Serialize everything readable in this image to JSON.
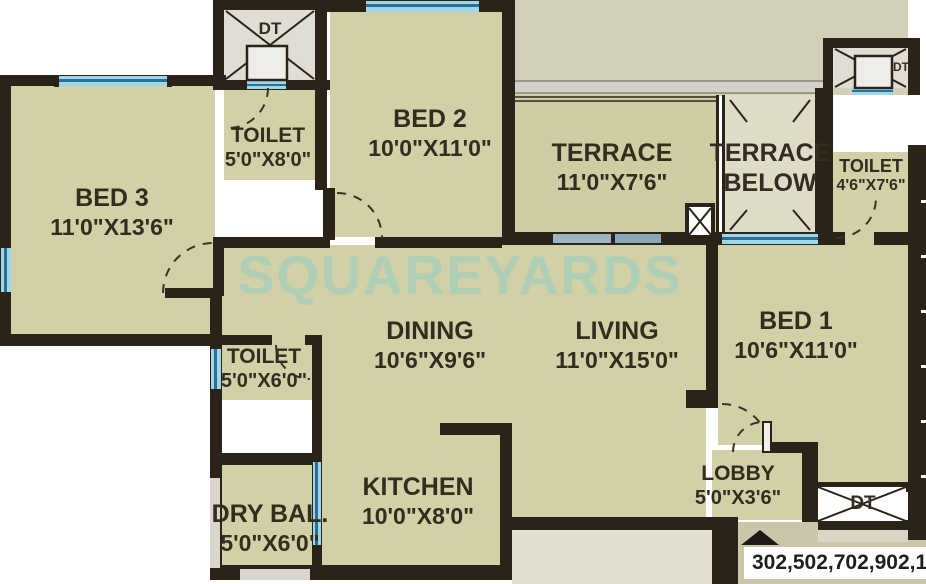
{
  "watermark": {
    "text": "SQUAREYARDS"
  },
  "plan": {
    "rooms": {
      "bed3": {
        "name": "BED 3",
        "dims": "11'0\"X13'6\""
      },
      "bed2": {
        "name": "BED 2",
        "dims": "10'0\"X11'0\""
      },
      "bed1": {
        "name": "BED 1",
        "dims": "10'6\"X11'0\""
      },
      "dining": {
        "name": "DINING",
        "dims": "10'6\"X9'6\""
      },
      "living": {
        "name": "LIVING",
        "dims": "11'0\"X15'0\""
      },
      "kitchen": {
        "name": "KITCHEN",
        "dims": "10'0\"X8'0\""
      },
      "terrace": {
        "name": "TERRACE",
        "dims": "11'0\"X7'6\""
      },
      "terrace_below": {
        "line1": "TERRACE",
        "line2": "BELOW"
      },
      "toilet_top": {
        "name": "TOILET",
        "dims": "5'0\"X8'0\""
      },
      "toilet_right": {
        "name": "TOILET",
        "dims": "4'6\"X7'6\""
      },
      "toilet_mid": {
        "name": "TOILET",
        "dims": "5'0\"X6'0\""
      },
      "dry_balcony": {
        "name": "DRY BAL.",
        "dims": "5'0\"X6'0\""
      },
      "lobby": {
        "name": "LOBBY",
        "dims": "5'0\"X3'6\""
      }
    },
    "shafts": {
      "dt_top": "DT",
      "dt_right": "DT",
      "dt_bottom": "DT"
    },
    "footer": {
      "units": "302,502,702,902,1102"
    }
  },
  "colors": {
    "wall": "#2b2317",
    "room_fill": "#d2d0a6",
    "terrace_below_fill": "#dedcc8",
    "shaft_fill": "#dfddd4",
    "outer_khaki": "#d2cfba",
    "outer_olive": "#c9c6a9",
    "outer_lightgreen": "#e0dfd0",
    "window_cyan": "#9ed7e8",
    "window_blue_line": "#2e6e96",
    "window_grayblue": "#9db4c4",
    "watermark": "#94cec4"
  }
}
